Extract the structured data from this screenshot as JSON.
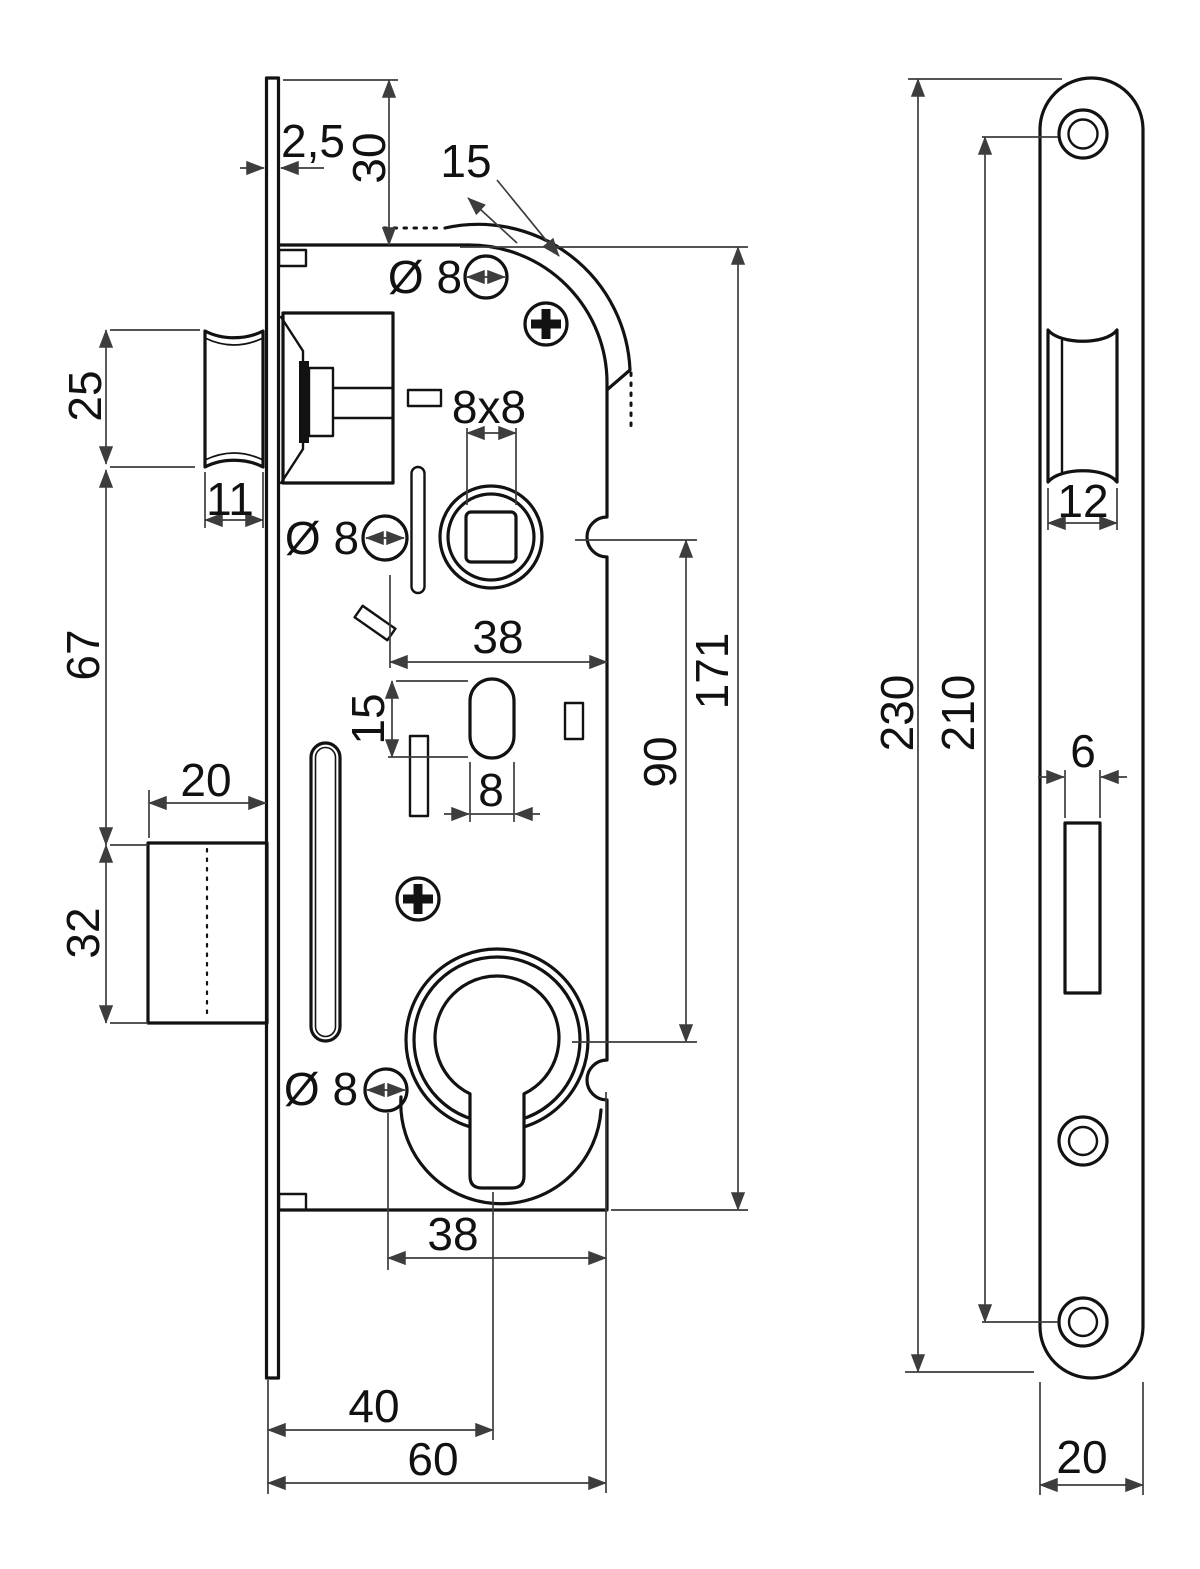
{
  "drawing": {
    "title": "Mortise lock dimensional drawing",
    "left_view": {
      "dims": {
        "faceplate_thickness": "2,5",
        "faceplate_top_offset": "30",
        "corner_radius": "15",
        "screw_top_dia": "Ø 8",
        "spindle_square": "8x8",
        "screw_mid_dia": "Ø 8",
        "latch_height": "25",
        "latch_depth": "11",
        "latch_to_deadbolt": "67",
        "deadbolt_depth": "20",
        "deadbolt_height": "32",
        "backset_upper": "38",
        "slot_height": "15",
        "slot_width": "8",
        "distance_centers": "90",
        "case_length": "171",
        "screw_bottom_dia": "Ø 8",
        "backset_lower": "38",
        "cylinder_offset": "40",
        "case_depth": "60"
      }
    },
    "right_view": {
      "dims": {
        "plate_length": "230",
        "screw_spacing": "210",
        "latch_cutout_width": "12",
        "deadbolt_cutout_width": "6",
        "plate_width": "20"
      }
    }
  }
}
